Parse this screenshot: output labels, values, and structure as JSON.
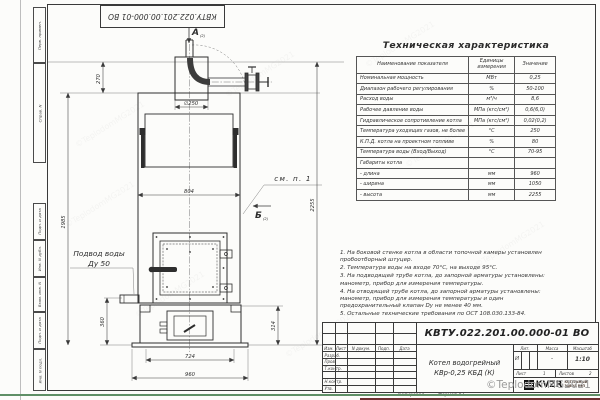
{
  "frame": {
    "top_designation": "КВТУ.022.201.00.000-01 ВО",
    "margin_fields": [
      "Перв. примен.",
      "Справ. N",
      "Подп. и дата",
      "Инв. N дубл.",
      "Взам. инв. N",
      "Подп. и дата",
      "Инв. N подл."
    ]
  },
  "drawing": {
    "view_a": "А",
    "view_a_ref": "(2)",
    "view_b": "Б",
    "view_b_ref": "(2)",
    "callout_note": "см. п. 1",
    "water_inlet_line1": "Подвод воды",
    "water_inlet_line2": "Ду 50",
    "dim_d250": "∅250",
    "dim_270": "270",
    "dim_804": "804",
    "dim_2255": "2255",
    "dim_1985": "1985",
    "dim_360": "360",
    "dim_314": "314",
    "dim_724": "724",
    "dim_960": "960"
  },
  "spec": {
    "title": "Техническая характеристика",
    "headers": [
      "Наименование показателя",
      "Единицы измерения",
      "Значение"
    ],
    "rows": [
      [
        "Номинальная мощность",
        "МВт",
        "0,25"
      ],
      [
        "Диапазон рабочего регулирования",
        "%",
        "50-100"
      ],
      [
        "Расход воды",
        "м³/ч",
        "8,6"
      ],
      [
        "Рабочее давление воды",
        "МПа (кгс/см²)",
        "0,6(6,0)"
      ],
      [
        "Гидравлическое сопротивление котла",
        "МПа (кгс/см²)",
        "0,02(0,2)"
      ],
      [
        "Температура уходящих газов, не более",
        "°С",
        "250"
      ],
      [
        "К.П.Д. котла на проектном топливе",
        "%",
        "80"
      ],
      [
        "Температура воды (Вход/Выход)",
        "°С",
        "70-95"
      ],
      [
        "Габариты котла",
        "",
        ""
      ],
      [
        "- длина",
        "мм",
        "960"
      ],
      [
        "- ширина",
        "мм",
        "1050"
      ],
      [
        "- высота",
        "мм",
        "2255"
      ]
    ]
  },
  "notes": [
    "1. На боковой стенке котла в области топочной камеры установлен пробоотборный штуцер.",
    "2. Температура воды на входе 70°С, на выходе 95°С.",
    "3. На подводящей трубе котла, до запорной арматуры установлены: манометр, прибор для измерения температуры.",
    "4. На отводящей трубе котла, до запорной арматуры установлены: манометр, прибор для измерения температуры и один предохранительный клапан Dу не менее 40 мм.",
    "5. Остальные технические требования по ОСТ 108.030.133-84."
  ],
  "title_block": {
    "designation": "КВТУ.022.201.00.000-01 ВО",
    "col_izm": "Изм.",
    "col_list": "Лист",
    "col_ndoc": "N докум.",
    "col_podp": "Подп.",
    "col_data": "Дата",
    "row_razrab": "Разраб.",
    "row_prov": "Пров.",
    "row_tkontr": "Т.контр.",
    "row_nkontr": "Н.контр.",
    "row_utv": "Утв.",
    "name_line1": "Котел водогрейный",
    "name_line2": "КВр-0,25 КБД (К)",
    "lit_label": "Лит.",
    "mass_label": "Масса",
    "scale_label": "Масштаб",
    "lit_value": "И",
    "mass_value": "-",
    "scale_value": "1:10",
    "sheet_label": "Лист",
    "sheet_value": "1",
    "sheets_label": "Листов",
    "sheets_value": "2",
    "logo_text": "KVZR",
    "company_line1": "КОТЕЛЬНЫЙ",
    "company_line2": "ЗАВОД РЭП"
  },
  "footer": {
    "copied": "Копировал",
    "format": "Формат А3"
  },
  "watermark": {
    "text": "©TeplodomMG2021",
    "color": "#9a9a9a"
  },
  "colors": {
    "line": "#3a3a3a",
    "paper": "#fcfcfa",
    "green_bar": "#5f8f66",
    "maroon_bar": "#6d3030"
  }
}
